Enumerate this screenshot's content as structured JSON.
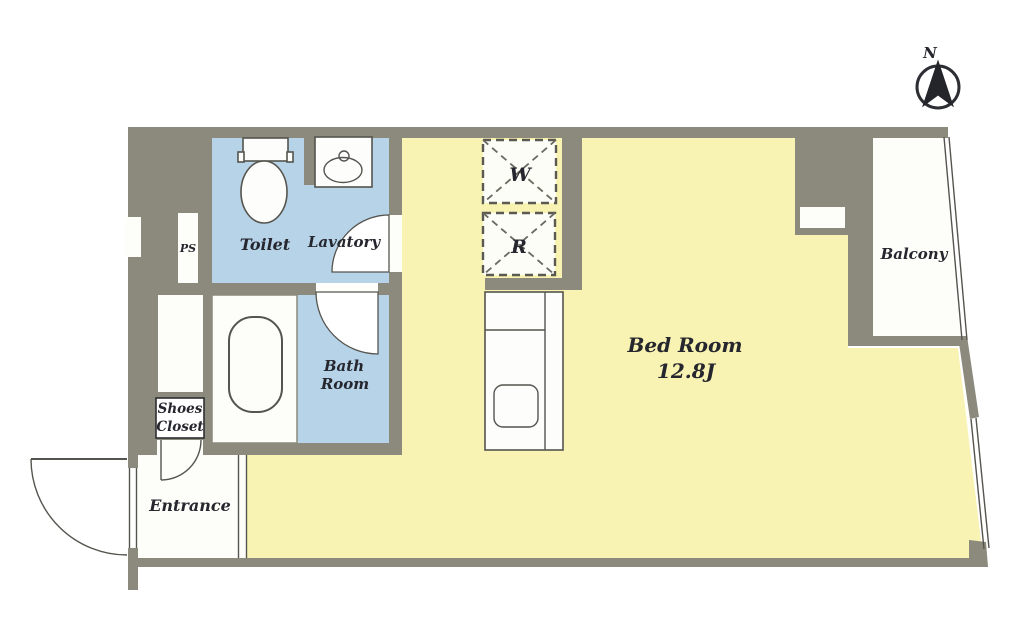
{
  "plan": {
    "compass_label": "N",
    "rooms": {
      "toilet": "Toilet",
      "lavatory": "Lavatory",
      "bath_line1": "Bath",
      "bath_line2": "Room",
      "bedroom_name": "Bed Room",
      "bedroom_size": "12.8J",
      "balcony": "Balcony",
      "entrance": "Entrance",
      "shoes_line1": "Shoes",
      "shoes_line2": "Closet",
      "pipe_space": "PS"
    },
    "appliances": {
      "washer": "W",
      "refrigerator": "R"
    },
    "colors": {
      "wall_gray": "#8b8a7c",
      "room_yellow": "#f8f3b2",
      "room_blue": "#b7d3e8",
      "floor_white": "#fdfdfa",
      "line_dark": "#55544e",
      "text_dark": "#26262e"
    }
  }
}
